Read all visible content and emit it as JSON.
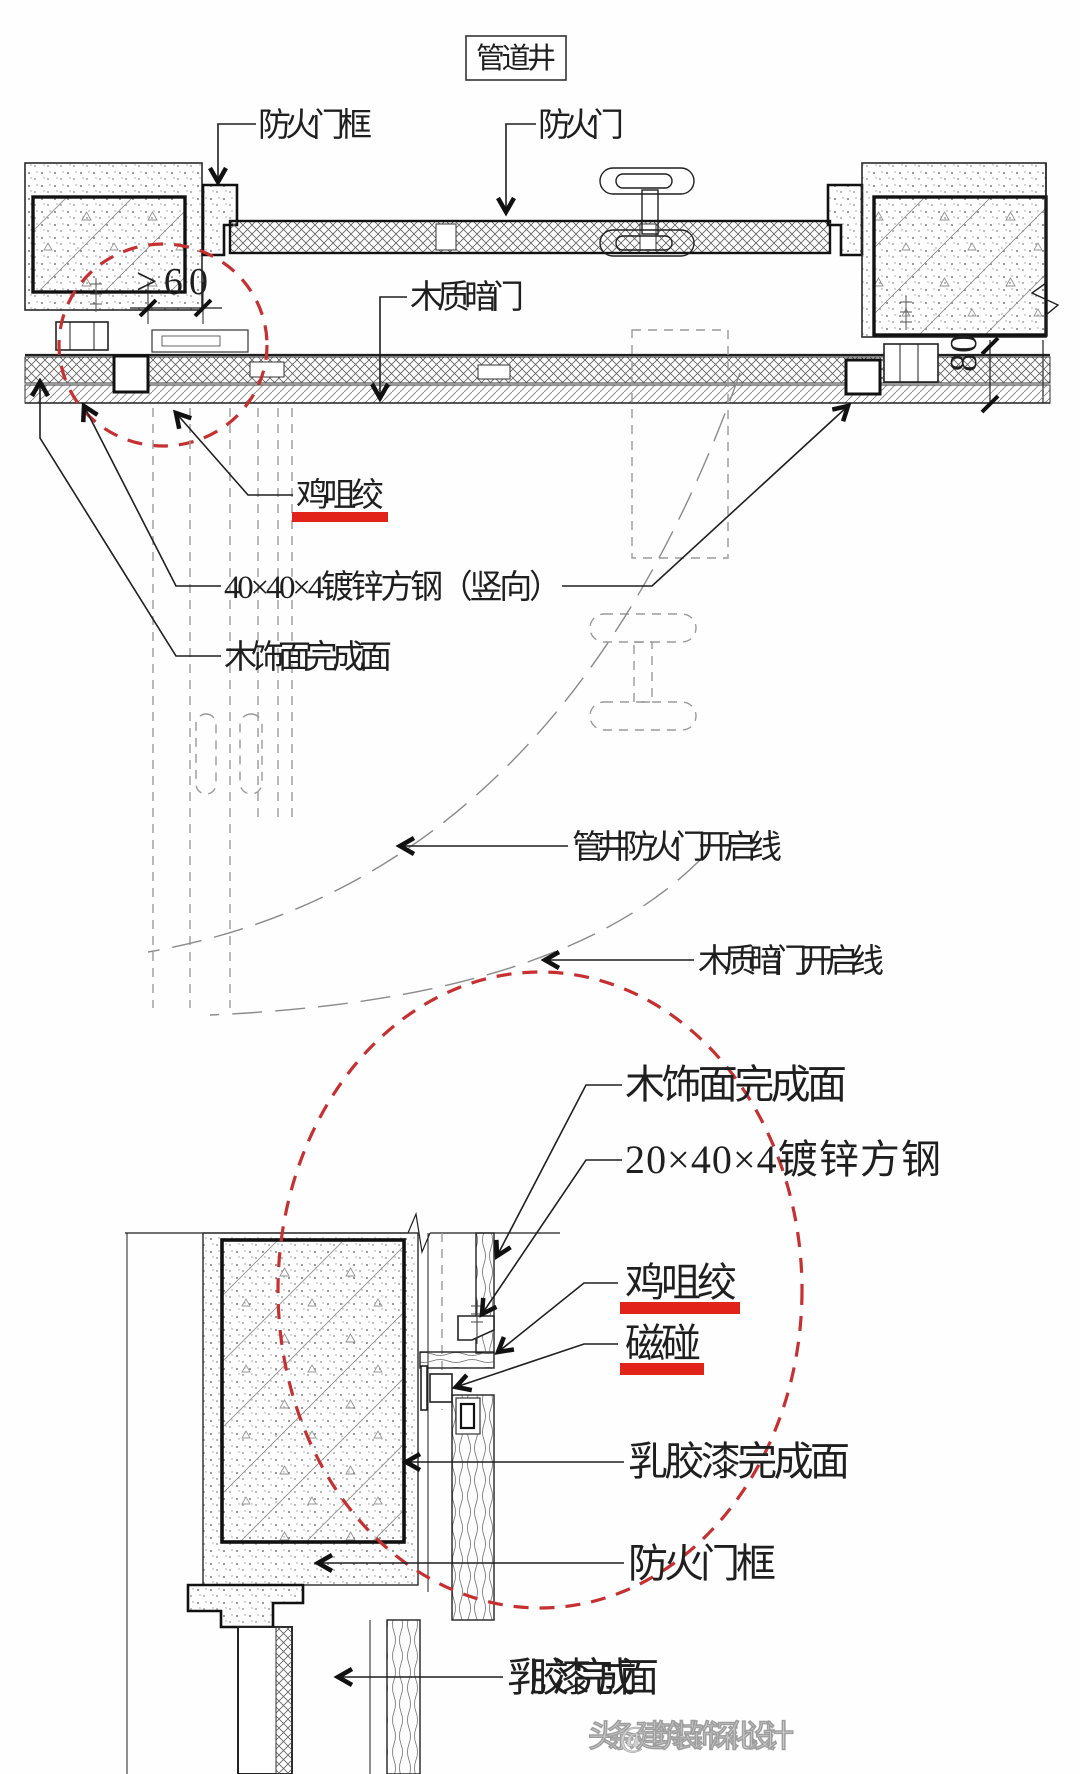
{
  "title": "管道井",
  "colors": {
    "red_accent": "#e2231a",
    "red_dash": "#c63031",
    "line": "#1f1f1f"
  },
  "top": {
    "fire_door_frame": "防火门框",
    "fire_door": "防火门",
    "hidden_door": "木质暗门",
    "hinge": "鸡咀绞",
    "steel_tube": "40×40×4镀锌方钢（竖向）",
    "wood_finish": "木饰面完成面",
    "fire_door_swing": "管井防火门开启线",
    "hidden_door_swing": "木质暗门开启线",
    "dim_min60": ">60",
    "dim_80": "80"
  },
  "bot": {
    "wood_finish": "木饰面完成面",
    "steel_tube": "20×40×4镀锌方钢",
    "hinge": "鸡咀绞",
    "magnet": "磁碰",
    "paint1": "乳胶漆完成面",
    "frame": "防火门框",
    "paint2": "乳胶漆完成面"
  },
  "watermark": "头条 @建筑装饰深化设计"
}
